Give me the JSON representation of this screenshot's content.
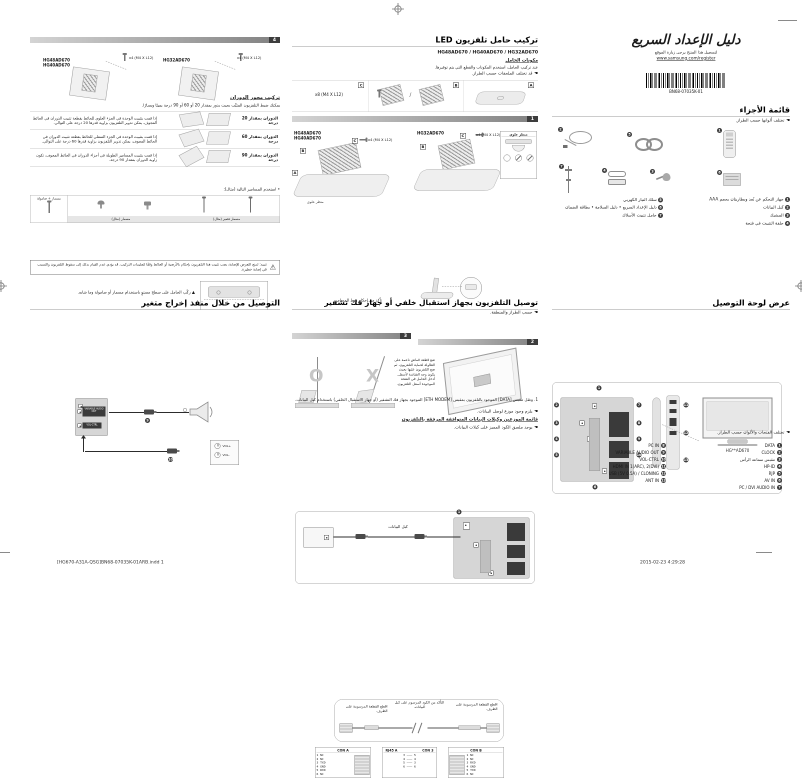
{
  "page": {
    "footer_left": "[HG670-A31A-QSG]BN68-07035K-01ARB.indd   1",
    "footer_right": "2015-02-23   4:29:28"
  },
  "cover": {
    "logo_title": "دليل الإعداد السريع",
    "register_note": "لتسجيل هذا المنتج يرجى زيارة الموقع",
    "register_url": "www.samsung.com/register",
    "barcode_text": "BN68-07035K-01",
    "parts_title": "قائمة الأجزاء",
    "parts_note": "تختلف ألوانها حسب الطراز.",
    "parts_right": [
      {
        "num": "1",
        "label": "جهاز التحكم عن بُعد وبطاريتان بحجم AAA"
      },
      {
        "num": "2",
        "label": "كبل البيانات"
      },
      {
        "num": "3",
        "label": "المشبك"
      },
      {
        "num": "4",
        "label": "حلقة التثبيت في فتحة"
      }
    ],
    "parts_left": [
      {
        "num": "5",
        "label": "سلك التيار الكهربي"
      },
      {
        "num": "6",
        "label": "دليل الإعداد السريع • دليل السلامة • بطاقة الضمان"
      },
      {
        "num": "7",
        "label": "حامل تثبيت الأسلاك"
      }
    ],
    "panel_title": "عرض لوحة التوصيل",
    "panel_note": "تختلف الفتحات والألوان حسب الطراز.",
    "tv_model": "HG**AD670",
    "callouts": [
      "1",
      "2",
      "3",
      "4",
      "5",
      "6",
      "7",
      "8",
      "9",
      "10",
      "11",
      "12",
      "13"
    ],
    "ports_left": [
      {
        "num": "8",
        "label": "PC IN"
      },
      {
        "num": "9",
        "label": "VARIABLE AUDIO OUT"
      },
      {
        "num": "10",
        "label": "VOL-CTRL"
      },
      {
        "num": "11",
        "label": "HDMI IN 1(ARC), 2(DVI)"
      },
      {
        "num": "12",
        "label": "USB (5V 0.5A) / CLONING"
      },
      {
        "num": "13",
        "label": "ANT IN"
      }
    ],
    "ports_right": [
      {
        "num": "1",
        "label": "DATA"
      },
      {
        "num": "2",
        "label": "CLOCK"
      },
      {
        "num": "3",
        "label": "مقبس سماعة الرأس"
      },
      {
        "num": "4",
        "label": "HP-ID"
      },
      {
        "num": "5",
        "label": "RJP"
      },
      {
        "num": "6",
        "label": "AV IN"
      },
      {
        "num": "7",
        "label": "PC / DVI AUDIO IN"
      }
    ]
  },
  "stand": {
    "title": "تركيب حامل تلفزيون LED",
    "models": "HG48AD670 / HG40AD670 / HG32AD670",
    "components_title": "مكونات الحامل",
    "components_text": "عند تركيب الحامل، استخدم المكونات والقطع التي يتم توفيرها.",
    "components_note": "قد تختلف الملحقات حسب الطراز.",
    "tag_a": "A",
    "tag_b": "B",
    "tag_c": "C",
    "slash": "/",
    "screws8": "x8 (M4 X L12)",
    "screws4": "x4 (M4 X L12)",
    "step1": "1",
    "step2": "2",
    "step3": "3",
    "models_left": "HG48AD670\nHG40AD670",
    "model_right": "HG32AD670",
    "top_view": "منظر علوي",
    "screw_caption": "تأكد من إحكام ربط المسامير.",
    "ok": "O",
    "no": "X",
    "step2_text": "ضع قطعة قماش ناعمة على\nالطاولة لحماية التلفزيون، ثم\nضع التلفزيون عليها بحيث\nيكون وجه الشاشة لأسفل.\nأدخل الحامل في الفتحة\nالموجودة أسفل التلفزيون."
  },
  "stb": {
    "title": "توصيل التلفزيون بجهاز استقبال خلفي أو جهاز فك تشفير",
    "note": "حسب الطراز والمنطقة.",
    "data_num": "1",
    "cable_label": "كبل البيانات",
    "note1": "1. وصّل مقبس [DATA] الموجود بالتلفزيون بمقبس [ETH MODEM] الموجود بجهاز فك التشفير (أو جهاز الاستقبال الخلفي) باستخدام كبل البيانات.",
    "note2": "يلزم وجود موزع لوصل البيانات.",
    "list_title": "قائمة الموزعين وكبلات البيانات المتوافقة المرفقة بالتلفزيون",
    "list_note": "يوجد ملصق الكود المميز على كبلات البيانات.",
    "end_label_right": "اقطع القطعة المرسومة على الطرف.",
    "end_label_left": "اقطع القطعة المرسومة على الطرف.",
    "mid_label": "التأكد من الكود المرسوم على كبل البيانات.",
    "con_a": "CON A",
    "con_b": "CON B",
    "rj_left": "RJ45 A",
    "rj_right": "CON 3",
    "pins_a": [
      "1 NC",
      "2 NC",
      "3 TXD",
      "4 GND",
      "5 RXD",
      "6 NC"
    ],
    "pins_b": [
      "1 NC",
      "2 NC",
      "3 RXD",
      "4 GND",
      "5 TXD",
      "6 NC"
    ],
    "maps": [
      "3 ——— 5",
      "4 ——— 4",
      "5 ——— 3",
      "6 ——— 6"
    ]
  },
  "wall": {
    "step4": "4",
    "models_left": "HG48AD670\nHG40AD670",
    "model_right": "HG32AD670",
    "screws4": "x4 (M4 X L12)",
    "swivel_title": "تركيب محور الدوران",
    "swivel_text": "يمكنك ضبط التلفزيون المثبَّت بحيث يدور بمقدار 20 أو 60 أو 90 درجة يمينًا ويسارًا.",
    "rows": [
      {
        "label": "الدوران بمقدار 20 درجة",
        "desc": "إذا قمت بتثبيت الوحدة في الجزء العلوي للحائط بقطعة تثبيت الدوران في الحائط المجوف، يمكن تدوير التلفزيون بزاوية قدرها 20 درجة على التوالي."
      },
      {
        "label": "الدوران بمقدار 60 درجة",
        "desc": "إذا قمت بتثبيت الوحدة في الجزء السفلي للحائط بقطعة تثبيت الدوران في الحائط المجوف، يمكن تدوير التلفزيون بزاوية قدرها 60 درجة على التوالي."
      },
      {
        "label": "الدوران بمقدار 90 درجة",
        "desc": "إذا قمت بتثبيت المسامير الطويلة في أجزاء الدوران في الحائط المجوف، تكون زاوية الدوران بمقدار 90 درجة."
      }
    ],
    "fastener_bullet": "استخدم المسامير التالية (مثال):",
    "fastener_head": "مسمار + صامولة",
    "caption_screw": "مسمار (مثال)",
    "caption_short": "مسمار قصير (مثال)",
    "flat_note": "ركّب الحامل على سطح مستوٍ باستخدام مسمار أو صامولة وما شابه.",
    "warning": "تنبيه: لمنع التعرض للإصابة، يجب تثبيت هذا التلفزيون بإحكام بالأرضية أو الحائط وفقًا لتعليمات التركيب. قد يؤدي عدم القيام بذلك إلى سقوط التلفزيون والتسبب في إصابة خطيرة.",
    "varout_title": "التوصيل من خلال منفذ إخراج متغير",
    "jack_variable": "VARIABLE AUDIO OUT",
    "jack_volctrl": "VOL-CTRL",
    "vol_plus": "VOL+",
    "vol_minus": "VOL-",
    "cn_var": "9",
    "cn_vol": "10"
  }
}
